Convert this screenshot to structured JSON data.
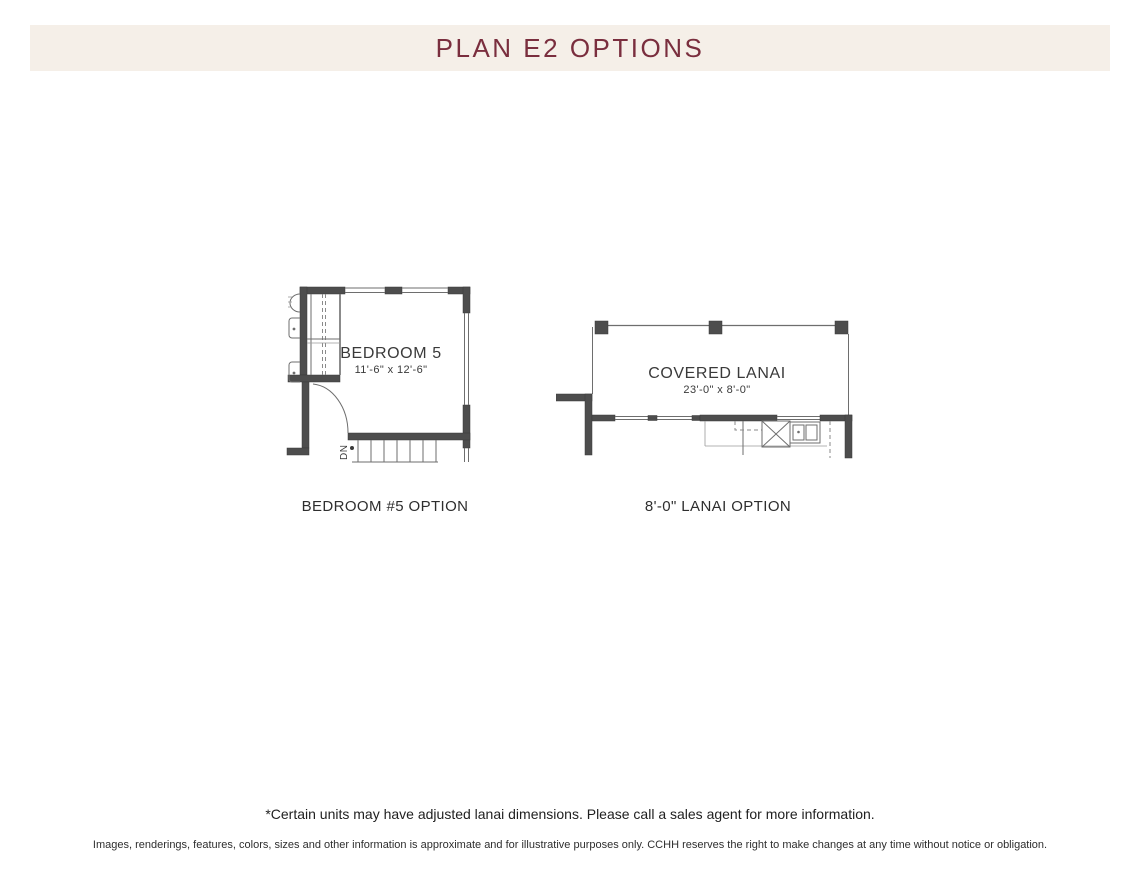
{
  "header": {
    "title": "PLAN E2 OPTIONS",
    "bg_color": "#f5efe8",
    "text_color": "#7a2e3e"
  },
  "plans": [
    {
      "name": "BEDROOM 5",
      "dimensions": "11'-6\" x 12'-6\"",
      "caption": "BEDROOM #5 OPTION",
      "stairs_label": "DN"
    },
    {
      "name": "COVERED LANAI",
      "dimensions": "23'-0\" x 8'-0\"",
      "caption": "8'-0\" LANAI OPTION"
    }
  ],
  "footnote": "*Certain units may have adjusted lanai dimensions. Please call a sales agent for more information.",
  "disclaimer": "Images, renderings, features, colors, sizes and other information is approximate and for illustrative purposes only. CCHH reserves the right to make changes at any time without notice or obligation.",
  "colors": {
    "wall": "#4d4d4d",
    "thin_line": "#6e6e6e",
    "plan_text": "#3a3a3a"
  }
}
